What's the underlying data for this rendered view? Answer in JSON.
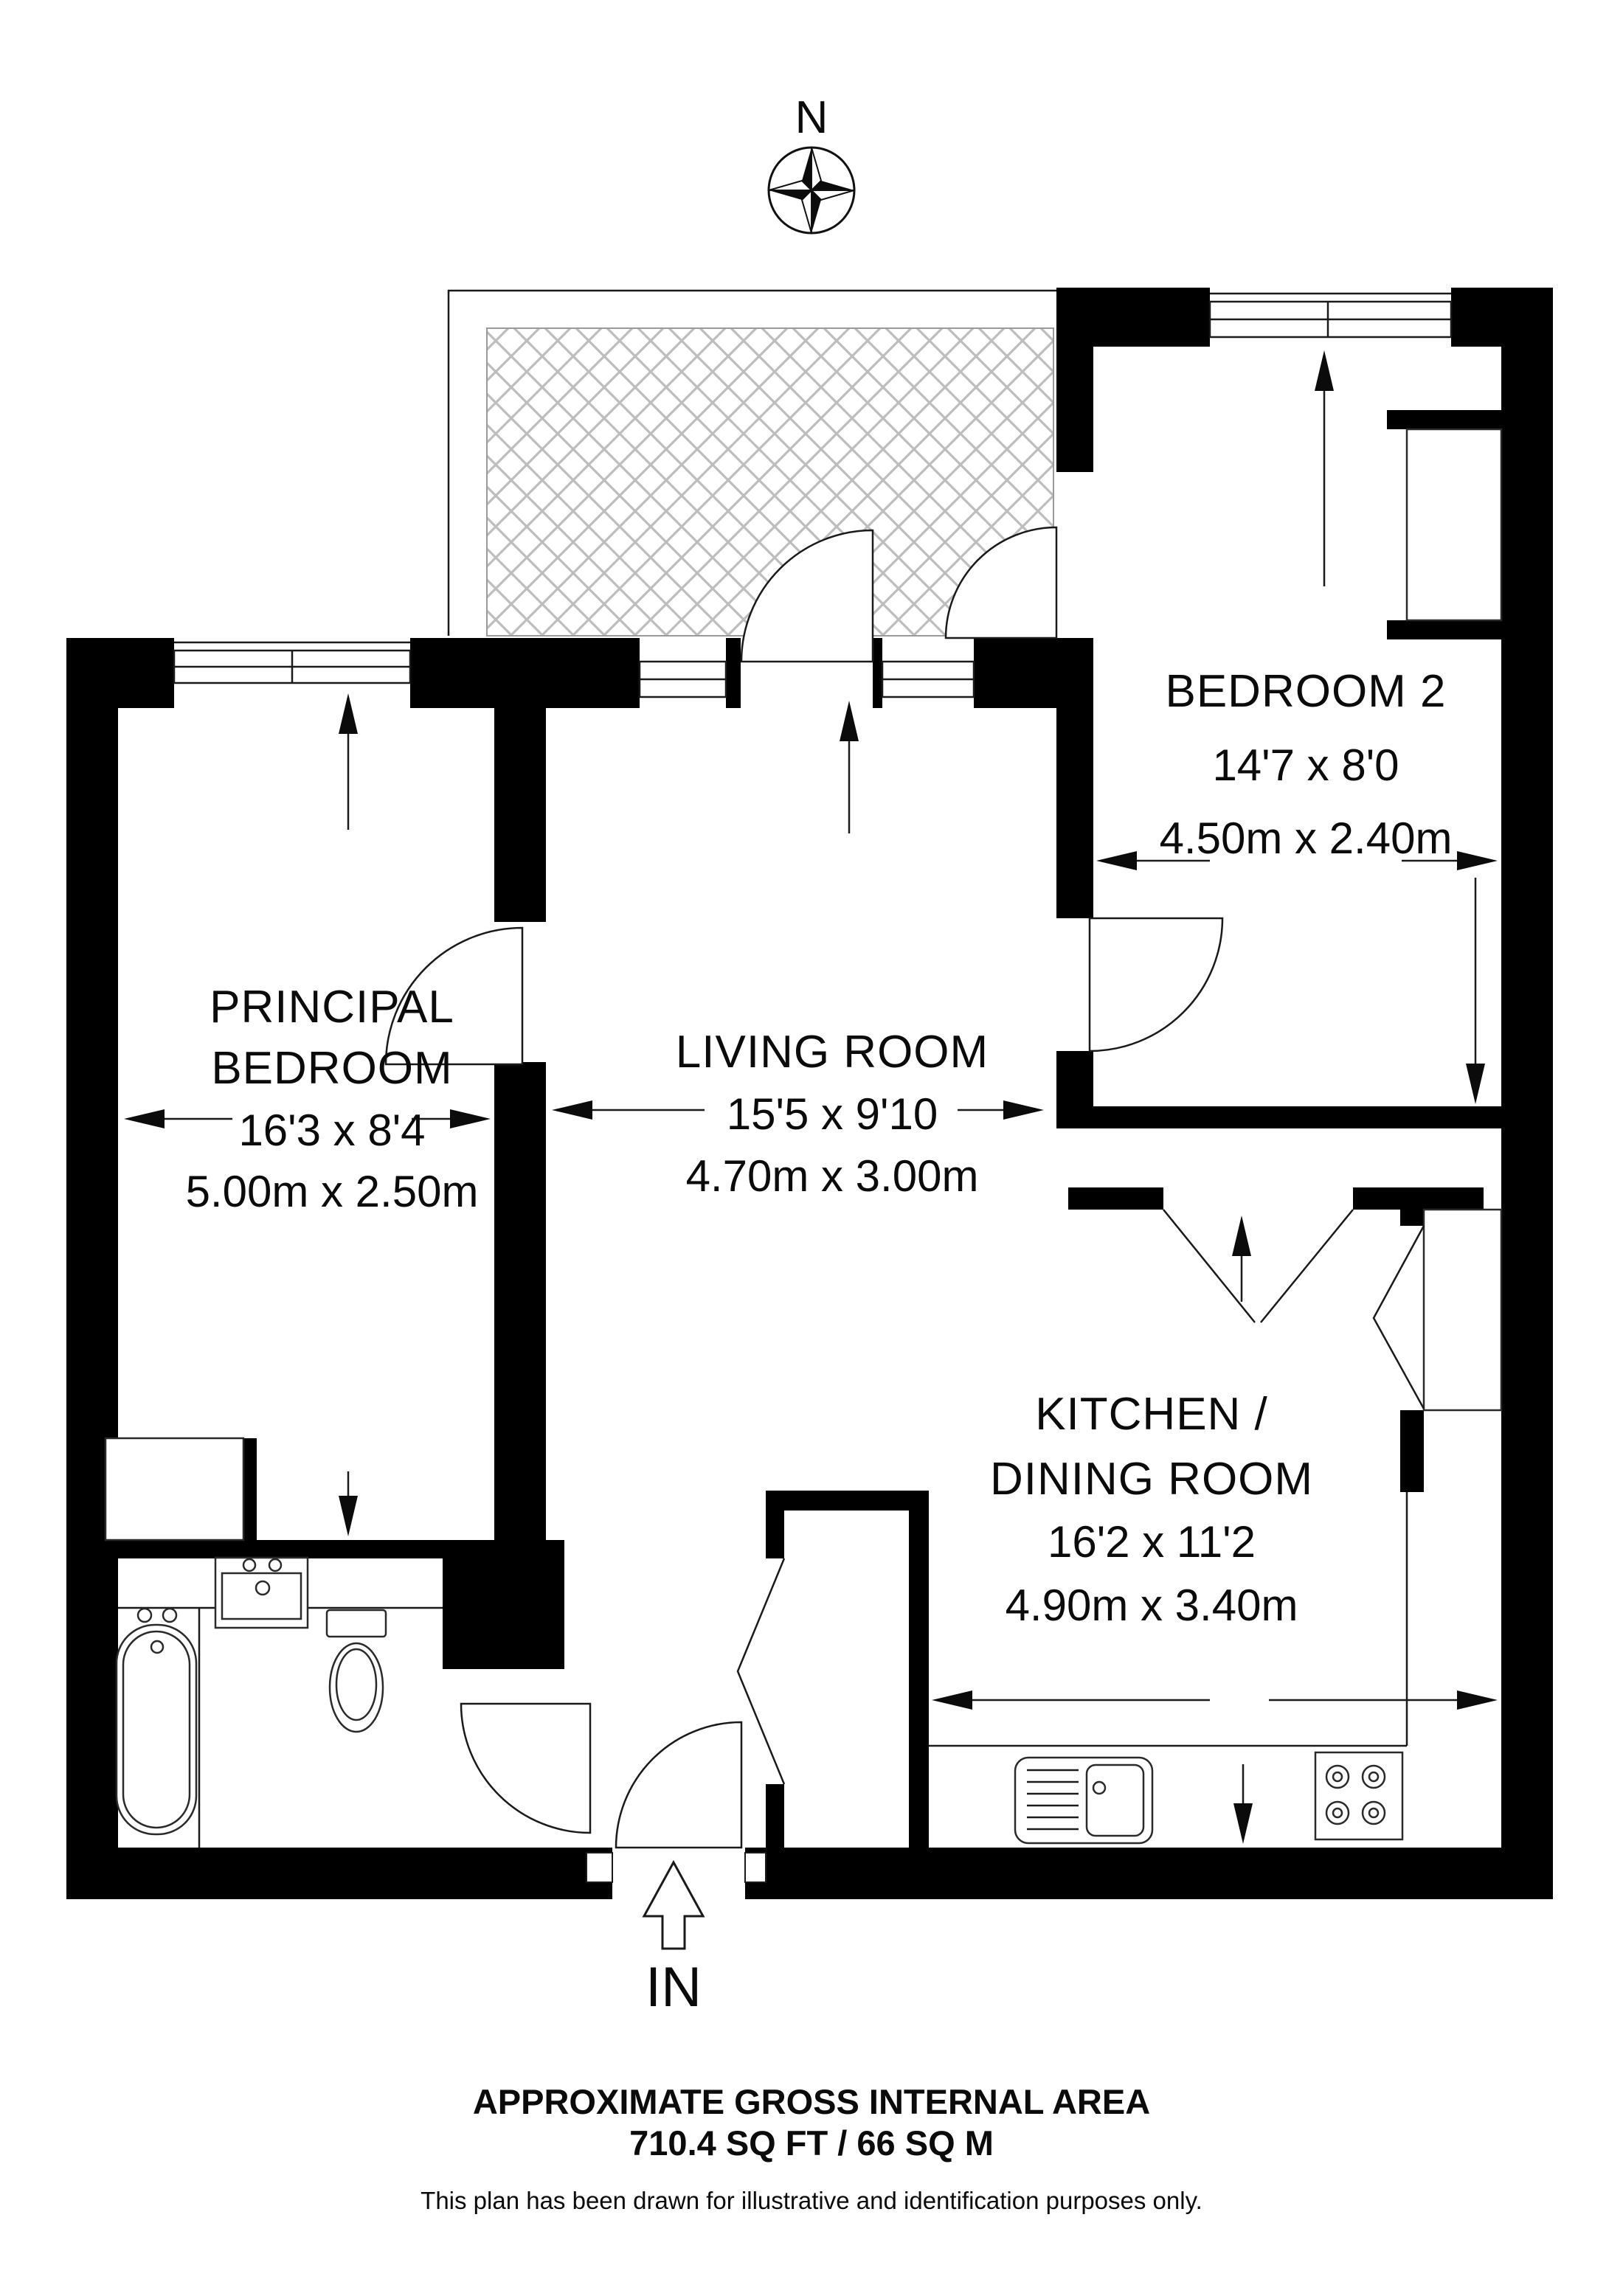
{
  "compass": {
    "label": "N"
  },
  "entrance": {
    "label": "IN"
  },
  "rooms": [
    {
      "id": "bedroom-2",
      "name_lines": [
        "BEDROOM 2"
      ],
      "imperial": "14'7 x 8'0",
      "metric": "4.50m x 2.40m"
    },
    {
      "id": "principal-bedroom",
      "name_lines": [
        "PRINCIPAL",
        "BEDROOM"
      ],
      "imperial": "16'3 x 8'4",
      "metric": "5.00m x 2.50m"
    },
    {
      "id": "living-room",
      "name_lines": [
        "LIVING ROOM"
      ],
      "imperial": "15'5 x 9'10",
      "metric": "4.70m x 3.00m"
    },
    {
      "id": "kitchen-dining",
      "name_lines": [
        "KITCHEN /",
        "DINING ROOM"
      ],
      "imperial": "16'2 x 11'2",
      "metric": "4.90m x 3.40m"
    }
  ],
  "footer": {
    "area_title": "APPROXIMATE GROSS INTERNAL AREA",
    "area_value": "710.4 SQ FT / 66 SQ M",
    "disclaimer": "This plan has been drawn for illustrative and identification purposes only."
  },
  "colors": {
    "wall": "#000000",
    "hatch": "#bdbdbd",
    "background": "#ffffff",
    "line": "#1a1a1a"
  }
}
